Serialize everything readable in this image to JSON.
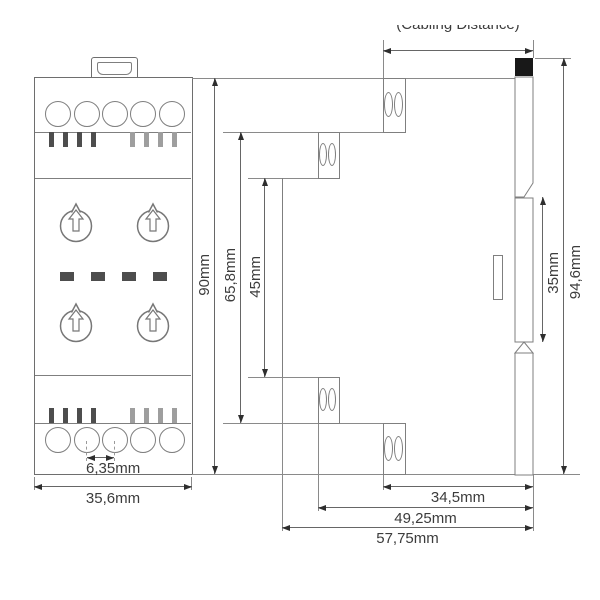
{
  "annotation": {
    "cabling_distance": "(Cabling Distance)"
  },
  "dims": {
    "front_height": "90mm",
    "terminal_span": "65,8mm",
    "body_span": "45mm",
    "front_width": "35,6mm",
    "terminal_pitch": "6,35mm",
    "rail_section_height": "35mm",
    "total_height": "94,6mm",
    "depth_to_terminals": "34,5mm",
    "depth_mid": "49,25mm",
    "depth_total": "57,75mm"
  },
  "colors": {
    "outline": "#6e6e6e",
    "line": "#7f7f7f",
    "dim_line": "#666666",
    "arrow": "#2e2e2e",
    "text": "#3c3c3c",
    "slot_dark": "#4d4d4d",
    "slot_light": "#9e9e9e",
    "led": "#4d4d4d",
    "marker_black": "#181818"
  }
}
